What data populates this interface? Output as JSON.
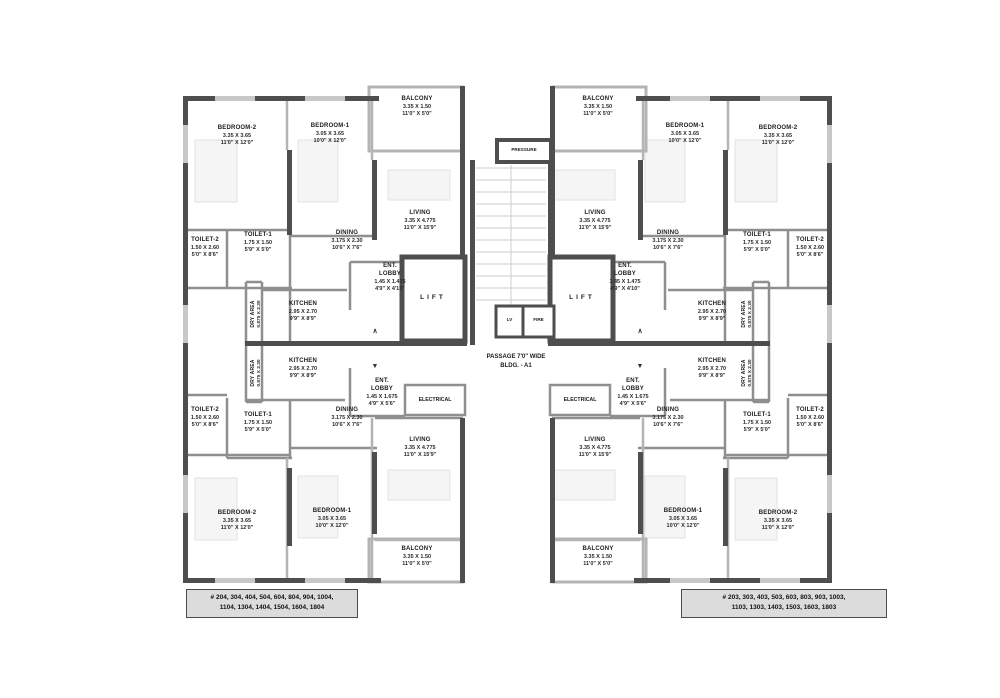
{
  "rooms": {
    "bedroom1": {
      "label": "BEDROOM-1",
      "m": "3.05 X 3.65",
      "ft": "10'0\" X 12'0\""
    },
    "bedroom2": {
      "label": "BEDROOM-2",
      "m": "3.35 X 3.65",
      "ft": "11'0\" X 12'0\""
    },
    "balcony": {
      "label": "BALCONY",
      "m": "3.35 X 1.50",
      "ft": "11'0\" X 5'0\""
    },
    "living": {
      "label": "LIVING",
      "m": "3.35 X 4.775",
      "ft": "11'0\" X 15'9\""
    },
    "dining": {
      "label": "DINING",
      "m": "3.175 X 2.30",
      "ft": "10'6\" X 7'6\""
    },
    "kitchen": {
      "label": "KITCHEN",
      "m": "2.95 X 2.70",
      "ft": "9'9\" X 8'9\""
    },
    "toilet1": {
      "label": "TOILET-1",
      "m": "1.75 X 1.50",
      "ft": "5'9\" X 5'0\""
    },
    "toilet2": {
      "label": "TOILET-2",
      "m": "1.50 X 2.60",
      "ft": "5'0\" X 8'6\""
    },
    "dry_area": {
      "label": "DRY AREA",
      "m": "0.875 X 2.30",
      "ft": "2'9\" X 7'6\""
    },
    "ent_lobby_upper": {
      "label": "ENT. LOBBY",
      "m": "1.45 X 1.475",
      "ft": "4'9\" X 4'10\""
    },
    "ent_lobby_lower": {
      "label": "ENT. LOBBY",
      "m": "1.45 X 1.675",
      "ft": "4'9\" X 5'6\""
    }
  },
  "center": {
    "pressure": "PRESSURE",
    "lv": "LV",
    "fire": "FIRE",
    "lift": "LIFT",
    "electrical": "ELECTRICAL",
    "passage_line1": "PASSAGE 7'0\" WIDE",
    "passage_line2": "BLDG. - A1",
    "arrow_up": "∧",
    "arrow_down": "▼"
  },
  "notes": {
    "left": {
      "line1": "# 204, 304, 404, 504, 604, 804, 904, 1004,",
      "line2": "1104, 1304, 1404, 1504, 1604, 1804"
    },
    "right": {
      "line1": "# 203, 303, 403, 503, 603, 803, 903, 1003,",
      "line2": "1103, 1303, 1403, 1503, 1603, 1803"
    }
  }
}
